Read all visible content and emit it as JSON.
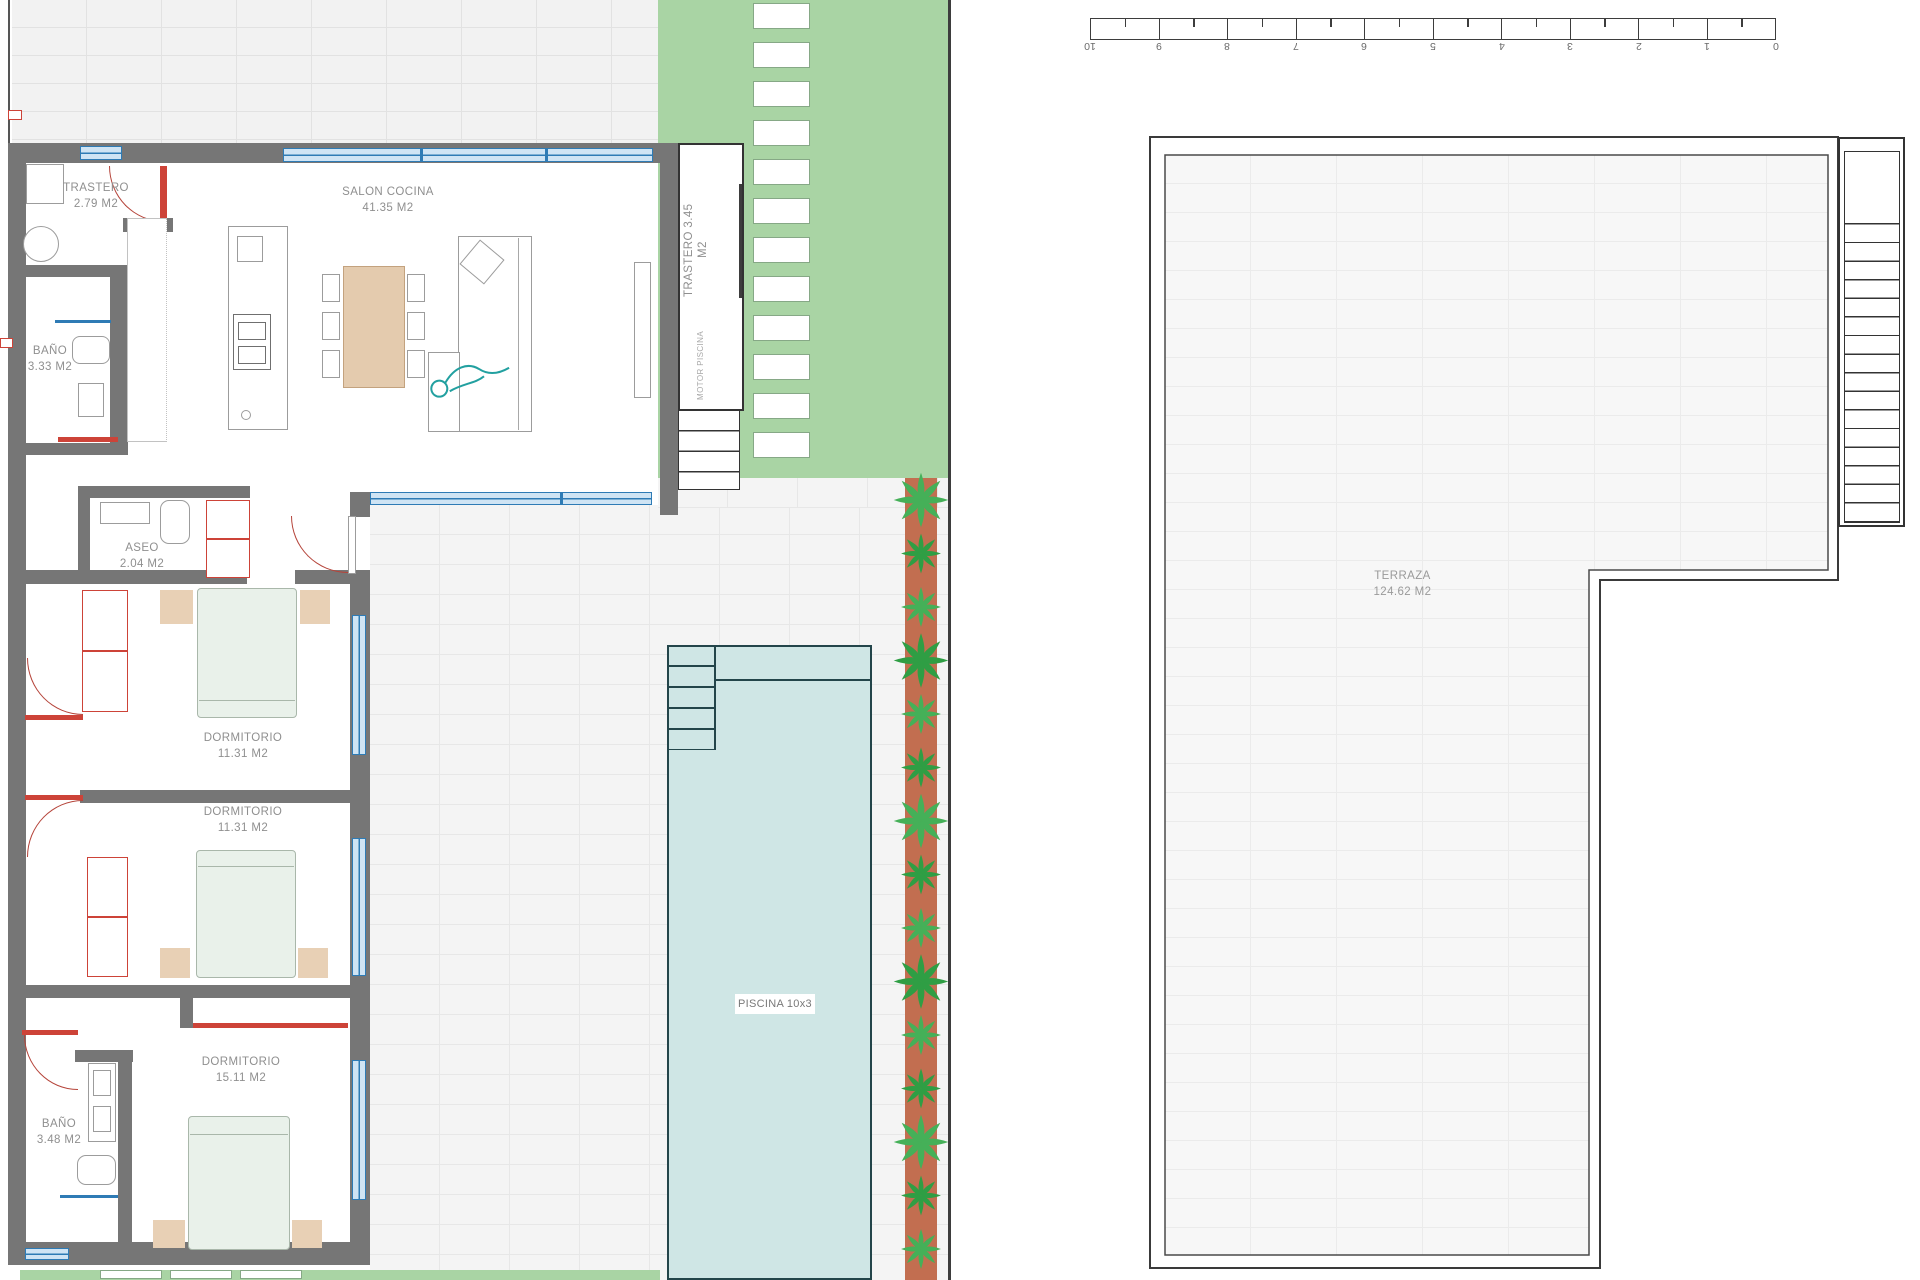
{
  "drawing": {
    "type": "architectural floor plan with terrace plan"
  },
  "rooms": {
    "trastero1": {
      "name": "TRASTERO",
      "area": "2.79 M2"
    },
    "salon": {
      "name": "SALON COCINA",
      "area": "41.35 M2"
    },
    "bano1": {
      "name": "BAÑO",
      "area": "3.33 M2"
    },
    "trastero2": {
      "name": "TRASTERO",
      "area": "3.45 M2"
    },
    "motor": {
      "name": "MOTOR  PISCINA"
    },
    "aseo": {
      "name": "ASEO",
      "area": "2.04 M2"
    },
    "dorm1": {
      "name": "DORMITORIO",
      "area": "11.31 M2"
    },
    "dorm2": {
      "name": "DORMITORIO",
      "area": "11.31 M2"
    },
    "dorm3": {
      "name": "DORMITORIO",
      "area": "15.11 M2"
    },
    "bano2": {
      "name": "BAÑO",
      "area": "3.48 M2"
    },
    "terraza": {
      "name": "TERRAZA",
      "area": "124.62 M2"
    }
  },
  "pool": {
    "label": "PISCINA 10x3"
  },
  "scale_bar": {
    "labels": [
      "10",
      "9",
      "8",
      "7",
      "6",
      "5",
      "4",
      "3",
      "2",
      "1",
      "0"
    ]
  },
  "colors": {
    "wall_gray": "#767676",
    "window_blue": "#2e7bb5",
    "accent_red": "#cd4338",
    "garden_green": "#a9d4a4",
    "pool_blue": "#cfe6e5",
    "plant_strip_terracotta": "#c26e50",
    "plant_green": "#2f9e44",
    "bed_green": "#e9f1ea",
    "wood_beige": "#e4cbae",
    "tile_line": "#e7e7e7"
  }
}
